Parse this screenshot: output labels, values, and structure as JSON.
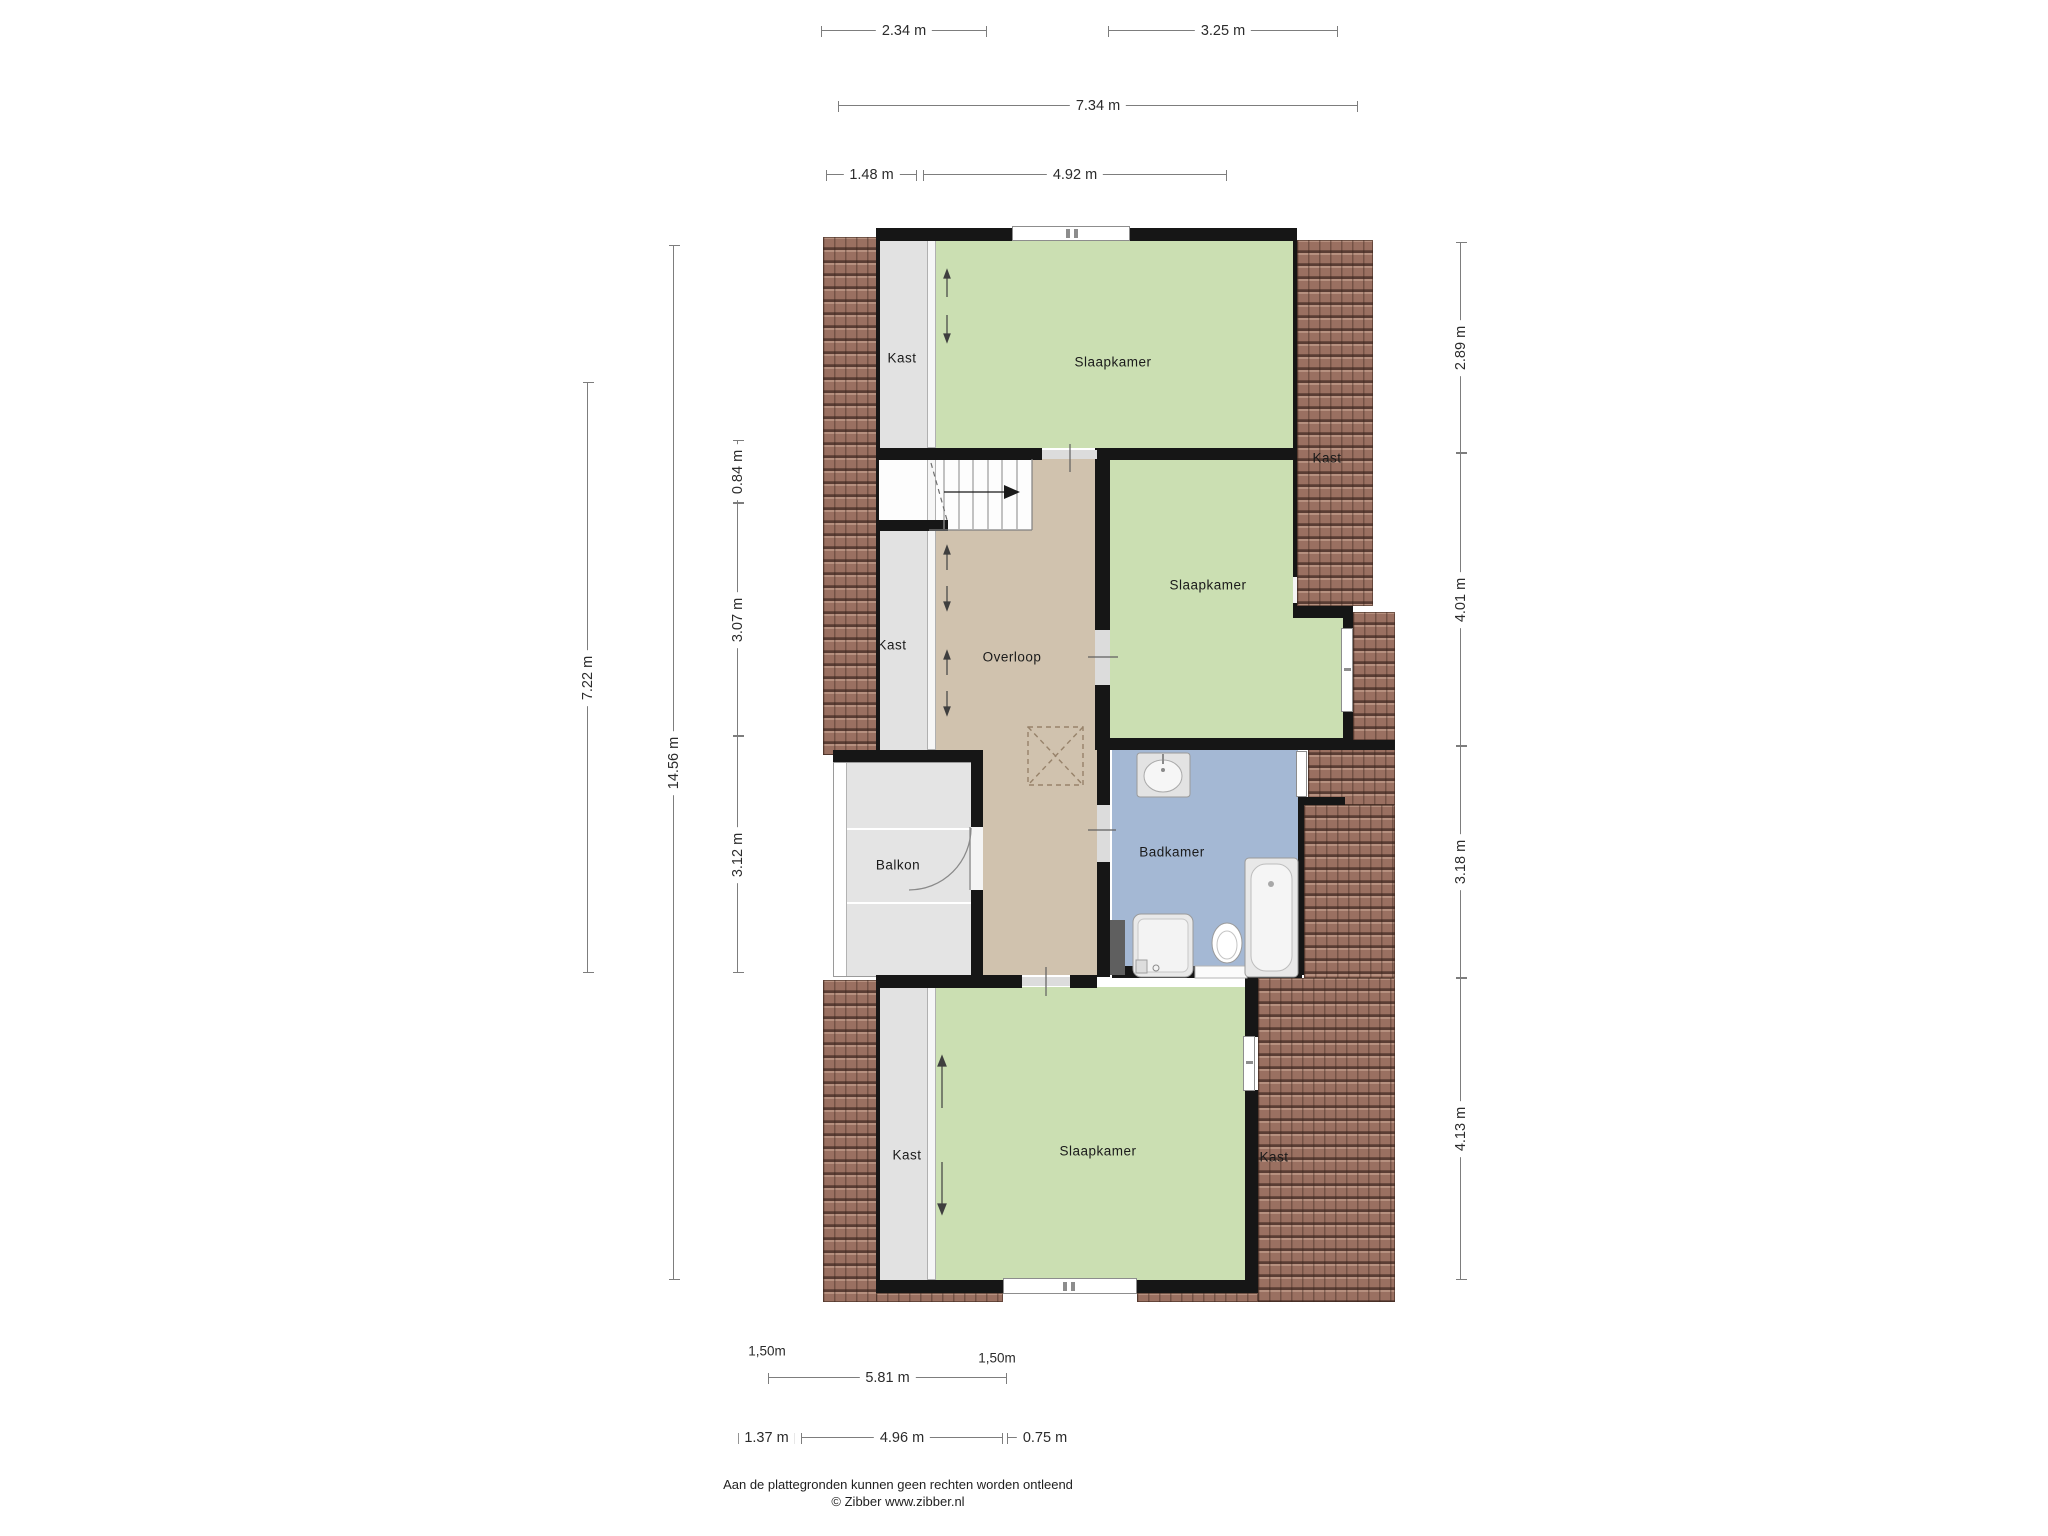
{
  "rooms": {
    "bedroom_top": "Slaapkamer",
    "bedroom_middle": "Slaapkamer",
    "bedroom_bottom": "Slaapkamer",
    "landing": "Overloop",
    "bathroom": "Badkamer",
    "balcony": "Balkon",
    "closet_top_left": "Kast",
    "closet_mid_left": "Kast",
    "closet_bottom_left": "Kast",
    "closet_right_top": "Kast",
    "closet_right_bottom": "Kast"
  },
  "dimensions": {
    "top": [
      "2.34 m",
      "3.25 m",
      "7.34 m",
      "1.48 m",
      "4.92 m"
    ],
    "left": [
      "7.22 m",
      "14.56 m",
      "0.84 m",
      "3.07 m",
      "3.12 m"
    ],
    "right": [
      "2.89 m",
      "4.01 m",
      "3.18 m",
      "4.13 m"
    ],
    "bottom": [
      "1,50m",
      "1,50m",
      "5.81 m",
      "1.37 m",
      "4.96 m",
      "0.75 m"
    ]
  },
  "footer": {
    "disclaimer": "Aan de plattegronden kunnen geen rechten worden ontleend",
    "credit": "© Zibber www.zibber.nl"
  },
  "colors": {
    "bedroom_fill": "#cbdfb2",
    "landing_fill": "#d0c2ae",
    "bathroom_fill": "#a4b8d4",
    "closet_fill": "#e2e2e2",
    "roof_tiles": "#9a7061",
    "walls": "#161616"
  }
}
